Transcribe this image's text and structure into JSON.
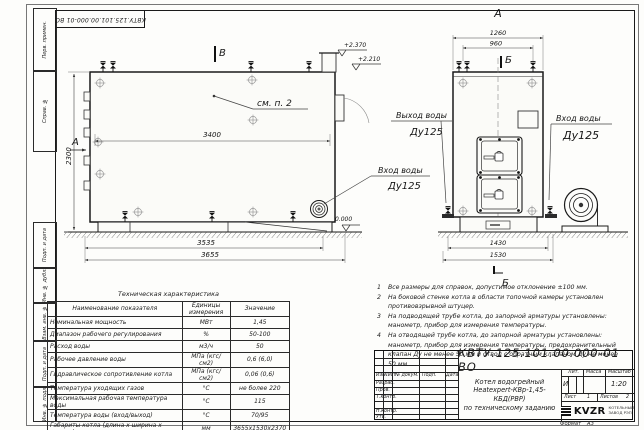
{
  "stamp_top": "КВТУ.125.101.00.000-01 ВО",
  "margin": {
    "perv_primen": "Перв. примен.",
    "sprav_no": "Справ. №",
    "podp_data1": "Подп. и дата",
    "inv_dubl": "Инв. № дубл.",
    "vzam_inv": "Взам. инв. №",
    "podp_data2": "Подп. и дата",
    "inv_podl": "Инв. № подл."
  },
  "drawing": {
    "side": {
      "section_mark": "В",
      "view_arrow": "А",
      "see_note": "см. п. 2",
      "dim_length_inner": "3400",
      "dim_height": "2300",
      "dim_base": "3535",
      "dim_overall": "3655",
      "level_top": "+2.370",
      "level_mid": "+2.210",
      "level_zero": "0.000",
      "outlet_line1": "Выход воды",
      "outlet_line2": "Ду125",
      "inlet_line1": "Вход воды",
      "inlet_line2": "Ду125"
    },
    "front": {
      "view_label": "А",
      "section_mark_top": "Б",
      "section_mark_bottom": "Б",
      "dim_outer": "1260",
      "dim_inner": "960",
      "dim_base": "1430",
      "dim_overall": "1530",
      "inlet_line1": "Вход воды",
      "inlet_line2": "Ду125"
    }
  },
  "notes": [
    {
      "num": "1",
      "text": "Все размеры для справок, допустимое отклонение ±100 мм."
    },
    {
      "num": "2",
      "text": "На боковой стенке котла в области топочной камеры установлен противовзрывной штуцер."
    },
    {
      "num": "3",
      "text": "На подводящей трубе котла, до запорной арматуры установлены: манометр, прибор для измерения температуры."
    },
    {
      "num": "4",
      "text": "На отводящей трубе котла, до запорной арматуры установлены: манометр, прибор для измерения температуры, предохранительный клапан Ду не менее 50 мм и отвод с обратным клапаном Ду не менее 50 мм."
    }
  ],
  "spec_table": {
    "title": "Техническая характеристика",
    "headers": [
      "Наименование показателя",
      "Единицы измерения",
      "Значение"
    ],
    "rows": [
      [
        "Номинальная мощность",
        "МВт",
        "1,45"
      ],
      [
        "Диапазон рабочего регулирования",
        "%",
        "50-100"
      ],
      [
        "Расход воды",
        "м3/ч",
        "50"
      ],
      [
        "Рабочее давление воды",
        "МПа (кгс/см2)",
        "0,6 (6,0)"
      ],
      [
        "Гидравлическое сопротивление котла",
        "МПа (кгс/см2)",
        "0,06 (0,6)"
      ],
      [
        "Температура уходящих газов",
        "°С",
        "не более 220"
      ],
      [
        "Максимальная рабочая температура воды",
        "°С",
        "115"
      ],
      [
        "Температура воды (вход/выход)",
        "°С",
        "70/95"
      ],
      [
        "Габариты котла (длина х ширина х высота)",
        "мм",
        "3655х1530х2370"
      ]
    ]
  },
  "title_block": {
    "designation": "КВТУ.125.101.00.000-01 ВО",
    "doc_name_line1": "Котел водогрейный",
    "doc_name_line2": "Heatexpert-КВр-1,45-КБД(РВР)",
    "doc_name_line3": "по техническому заданию",
    "col_izm": "Изм.",
    "col_list": "Лист",
    "col_dokum": "№ докум.",
    "col_podp": "Подп.",
    "col_data": "Дата",
    "row_razrab": "Разраб.",
    "row_prov": "Пров.",
    "row_tkontr": "Т.контр.",
    "row_nkontr": "Н.контр.",
    "row_utv": "Утв.",
    "lit_label": "Лит.",
    "lit_value": "И",
    "mass_label": "Масса",
    "scale_label": "Масштаб",
    "scale_value": "1:20",
    "sheet_label": "Лист",
    "sheet_value": "1",
    "sheets_label": "Листов",
    "sheets_value": "2",
    "company_logo": "KVZR",
    "company_name_line1": "КОТЕЛЬНЫЙ",
    "company_name_line2": "ЗАВОД РЭП",
    "format_label": "Формат",
    "format_value": "А3"
  }
}
